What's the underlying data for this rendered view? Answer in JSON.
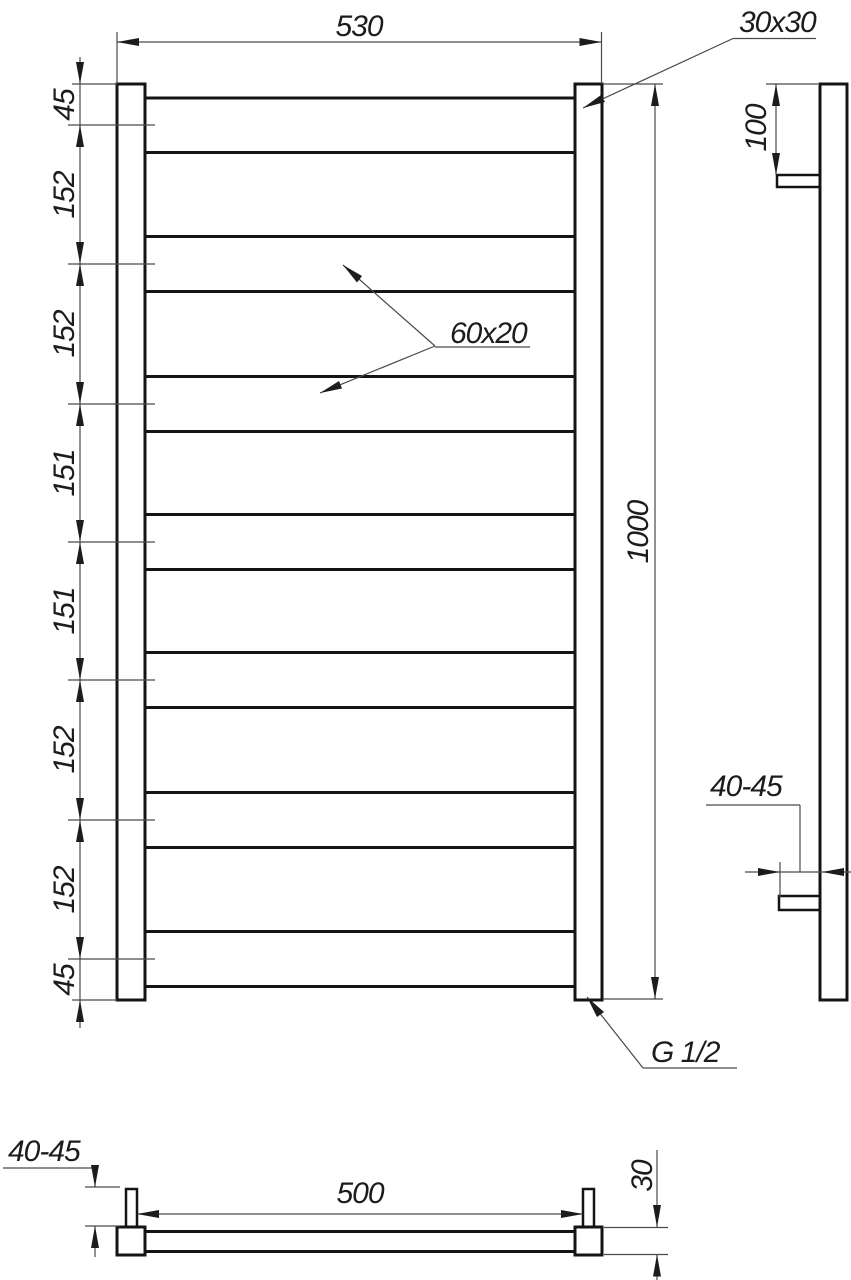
{
  "drawing": {
    "front_view": {
      "width_dim": "530",
      "height_dim": "1000",
      "post_profile_label": "30x30",
      "rung_profile_label": "60x20",
      "thread_label": "G 1/2",
      "spacing_chain": [
        "45",
        "152",
        "152",
        "151",
        "151",
        "152",
        "152",
        "45"
      ]
    },
    "side_view": {
      "top_offset_dim": "100",
      "wall_distance_dim": "40-45"
    },
    "bottom_view": {
      "wall_distance_dim": "40-45",
      "connection_spacing_dim": "500",
      "depth_dim": "30"
    },
    "colors": {
      "background": "#ffffff",
      "outline": "#141414",
      "dimension_line": "#4a4a4a",
      "text": "#1c1c1c"
    }
  }
}
